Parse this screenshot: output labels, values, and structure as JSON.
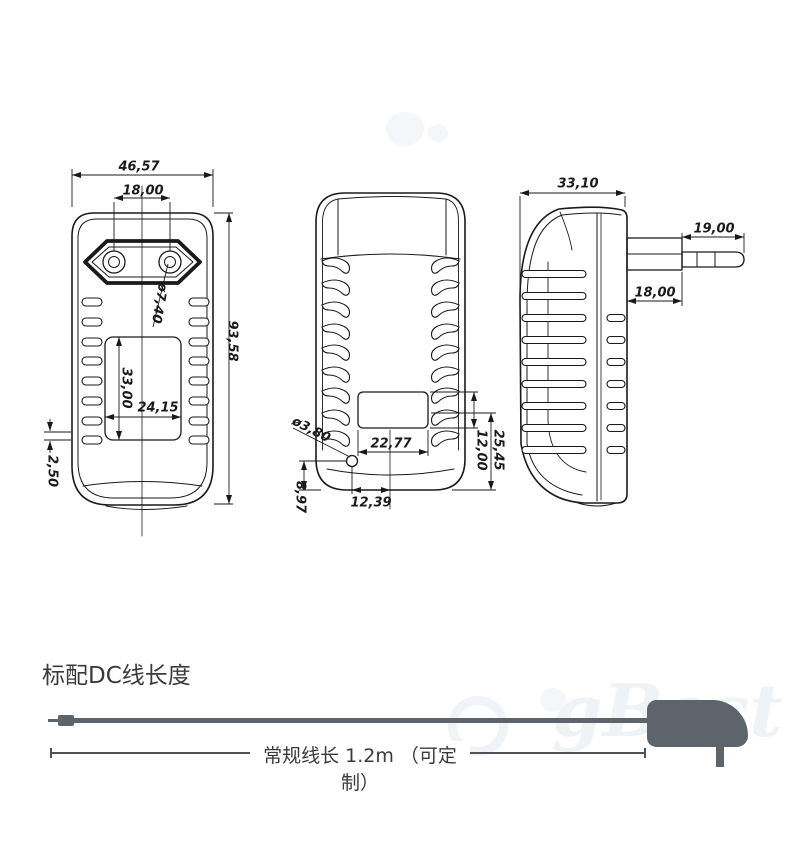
{
  "drawing": {
    "front_view": {
      "overall_width": "46,57",
      "pin_spacing": "18,00",
      "pin_diameter": "ø7,40",
      "overall_height": "93,58",
      "recess_height": "33,00",
      "recess_width": "24,15",
      "bottom_gap": "2,50"
    },
    "back_view": {
      "hole_diameter": "ø3,80",
      "recess_width": "22,77",
      "hole_offset": "12,39",
      "hole_height": "8,97",
      "recess_to_bottom": "25,45",
      "recess_height": "12,00"
    },
    "side_view": {
      "body_depth": "33,10",
      "pin_length": "19,00",
      "pin_seat_width": "18,00"
    }
  },
  "cable_section": {
    "heading": "标配DC线长度",
    "length_label": "常规线长 1.2m （可定制）"
  },
  "watermark": "gBest",
  "colors": {
    "line": "#1a1a1a",
    "cable": "#5d646b",
    "text": "#3a3a3a"
  }
}
